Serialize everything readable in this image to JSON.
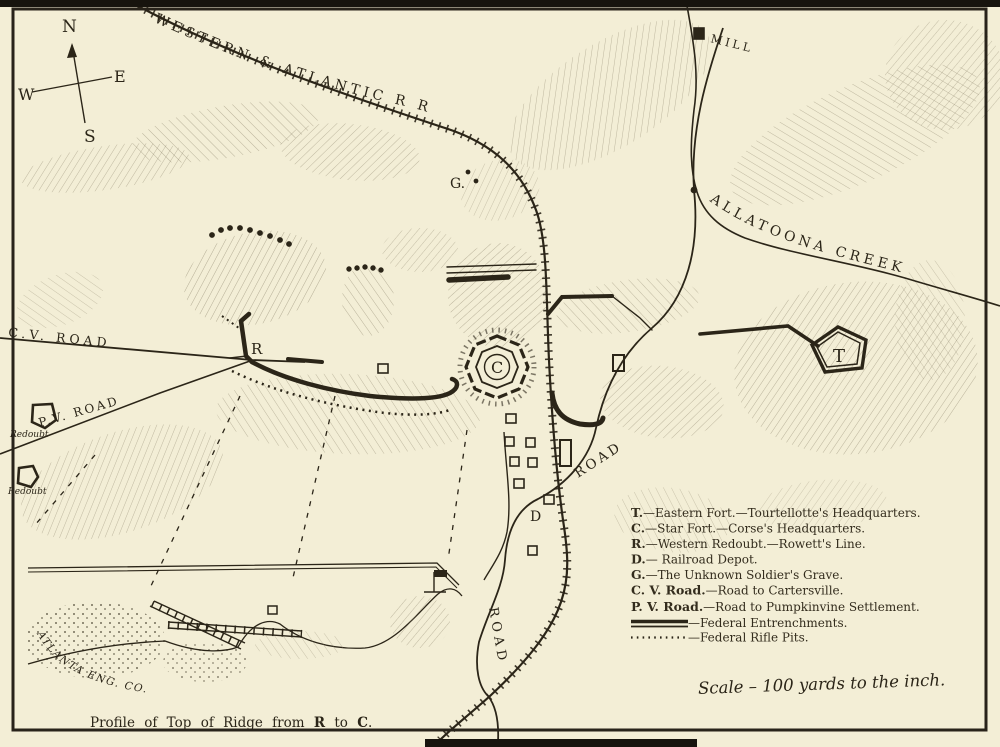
{
  "compass": {
    "north": "N",
    "east": "E",
    "south": "S",
    "west": "W"
  },
  "map_labels": {
    "railroad": "WESTERN & ATLANTIC R R",
    "creek": "ALLATOONA CREEK",
    "mill": "MILL",
    "cv_road": "C.V.  ROAD",
    "pv_road": "P.V. ROAD",
    "road_upper": "ROAD",
    "road_lower": "ROAD",
    "grave": "G.",
    "western_redoubt": "R",
    "star_fort": "C",
    "eastern_fort": "T",
    "depot": "D",
    "redoubt_west_1": "Redoubt",
    "redoubt_west_2": "Redoubt"
  },
  "legend": {
    "items": [
      {
        "key": "T.",
        "desc": "—Eastern Fort.—Tourtellotte's Headquarters."
      },
      {
        "key": "C.",
        "desc": "—Star Fort.—Corse's Headquarters."
      },
      {
        "key": "R.",
        "desc": "—Western Redoubt.—Rowett's Line."
      },
      {
        "key": "D.",
        "desc": "— Railroad Depot."
      },
      {
        "key": "G.",
        "desc": "—The Unknown Soldier's Grave."
      },
      {
        "key": "C. V. Road.",
        "desc": "—Road to Cartersville."
      },
      {
        "key": "P. V. Road.",
        "desc": "—Road to Pumpkinvine Settlement."
      }
    ],
    "entrenchments": "—Federal Entrenchments.",
    "rifle_pits": "—Federal Rifle Pits."
  },
  "notes": {
    "scale": "Scale – 100 yards to the inch.",
    "engraver": "ATLANTA  ENG.  CO.",
    "profile_caption": {
      "pre": "Profile of Top of Ridge from ",
      "r": "R",
      "mid": " to ",
      "c": "C",
      "end": "."
    }
  },
  "colors": {
    "paper": "#f3eed6",
    "ink": "#2b2518",
    "hatch": "#8a8169"
  }
}
